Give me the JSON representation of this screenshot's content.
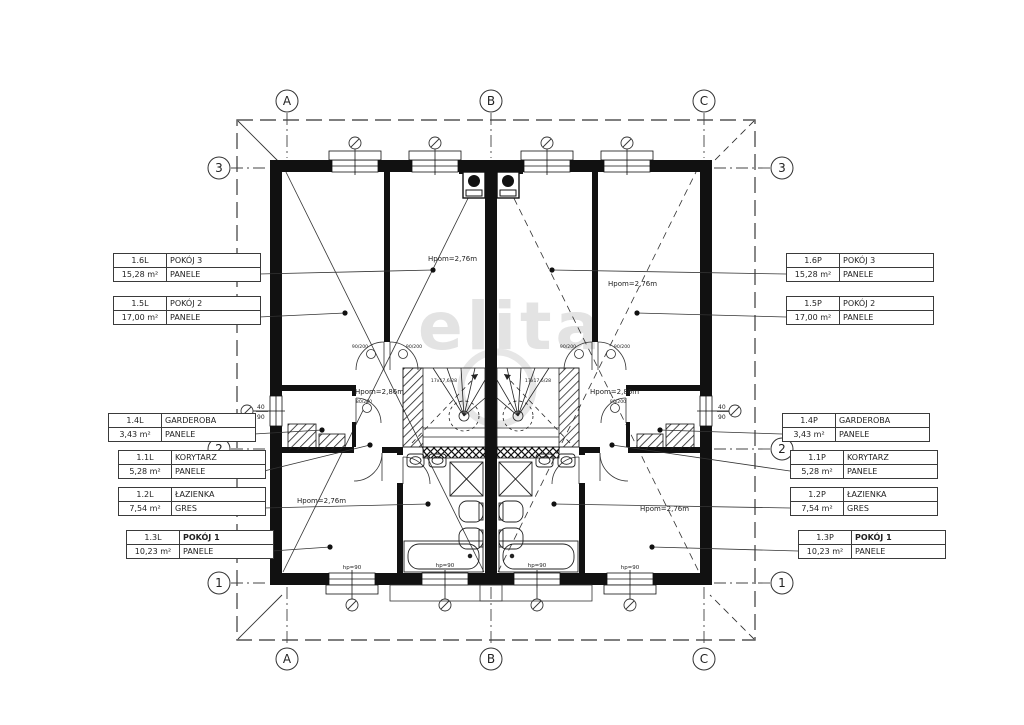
{
  "watermark": "elita",
  "axis": {
    "cols": [
      "A",
      "B",
      "C"
    ],
    "rows": [
      "3",
      "2",
      "1"
    ]
  },
  "left_labels": [
    {
      "id": "1.6L",
      "name": "POKÓJ 3",
      "area": "15,28 m²",
      "finish": "PANELE"
    },
    {
      "id": "1.5L",
      "name": "POKÓJ 2",
      "area": "17,00 m²",
      "finish": "PANELE"
    },
    {
      "id": "1.4L",
      "name": "GARDEROBA",
      "area": "3,43 m²",
      "finish": "PANELE"
    },
    {
      "id": "1.1L",
      "name": "KORYTARZ",
      "area": "5,28 m²",
      "finish": "PANELE"
    },
    {
      "id": "1.2L",
      "name": "ŁAZIENKA",
      "area": "7,54 m²",
      "finish": "GRES"
    },
    {
      "id": "1.3L",
      "name": "POKÓJ 1",
      "area": "10,23 m²",
      "finish": "PANELE"
    }
  ],
  "right_labels": [
    {
      "id": "1.6P",
      "name": "POKÓJ 3",
      "area": "15,28 m²",
      "finish": "PANELE"
    },
    {
      "id": "1.5P",
      "name": "POKÓJ 2",
      "area": "17,00 m²",
      "finish": "PANELE"
    },
    {
      "id": "1.4P",
      "name": "GARDEROBA",
      "area": "3,43 m²",
      "finish": "PANELE"
    },
    {
      "id": "1.1P",
      "name": "KORYTARZ",
      "area": "5,28 m²",
      "finish": "PANELE"
    },
    {
      "id": "1.2P",
      "name": "ŁAZIENKA",
      "area": "7,54 m²",
      "finish": "GRES"
    },
    {
      "id": "1.3P",
      "name": "POKÓJ 1",
      "area": "10,23 m²",
      "finish": "PANELE"
    }
  ],
  "heights": {
    "top_left": "Hpom=2,76m",
    "top_right": "Hpom=2,76m",
    "mid_left": "Hpom=2,86m",
    "mid_right": "Hpom=2,86m",
    "bottom_left": "Hpom=2,76m",
    "bottom_right": "Hpom=2,76m"
  },
  "dims": {
    "hp": "hp=90",
    "window_w": "40",
    "window_h": "90",
    "door_room": "90/200",
    "door_small": "80/200",
    "stair": "17x17,6/28"
  }
}
